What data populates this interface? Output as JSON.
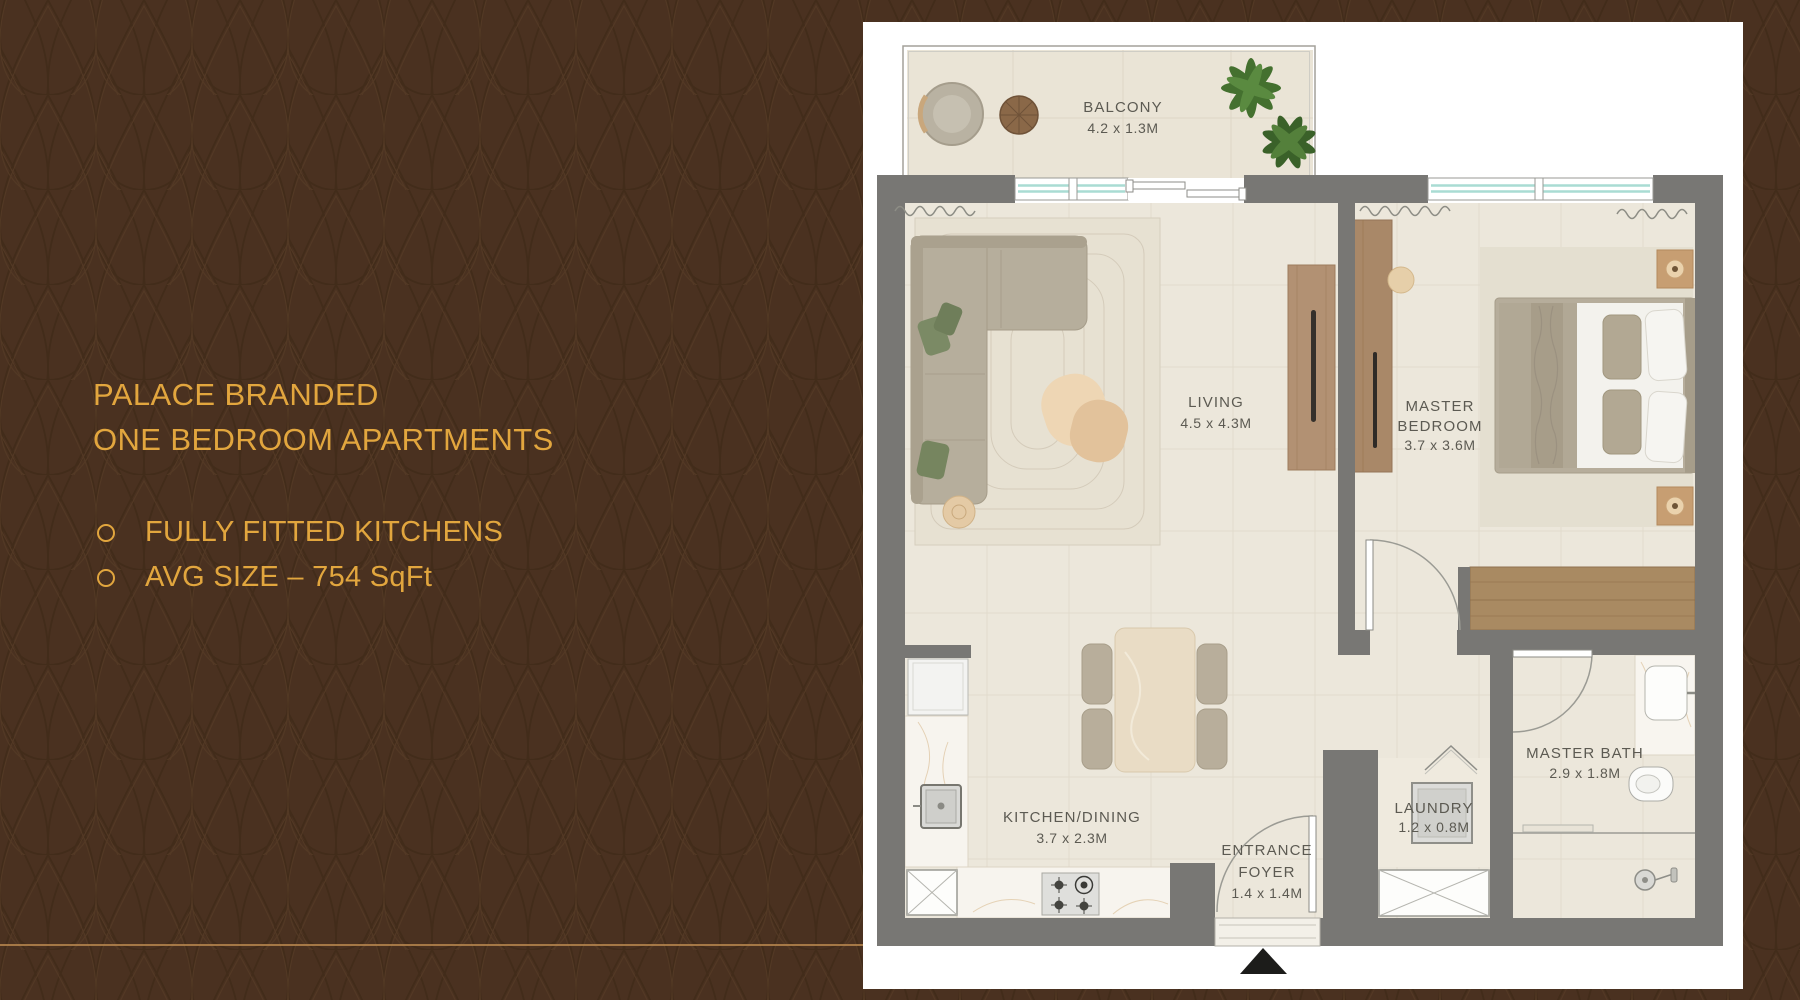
{
  "left_panel": {
    "title_line1": "PALACE BRANDED",
    "title_line2": "ONE BEDROOM APARTMENTS",
    "bullets": [
      "FULLY FITTED KITCHENS",
      "AVG SIZE – 754 SqFt"
    ]
  },
  "floor_plan": {
    "rooms": {
      "balcony": {
        "name": "BALCONY",
        "dims": "4.2 x 1.3M"
      },
      "living": {
        "name": "LIVING",
        "dims": "4.5 x 4.3M"
      },
      "master_bedroom": {
        "name_line1": "MASTER",
        "name_line2": "BEDROOM",
        "dims": "3.7 x 3.6M"
      },
      "kitchen_dining": {
        "name": "KITCHEN/DINING",
        "dims": "3.7 x 2.3M"
      },
      "entrance_foyer": {
        "name_line1": "ENTRANCE",
        "name_line2": "FOYER",
        "dims": "1.4 x 1.4M"
      },
      "laundry": {
        "name": "LAUNDRY",
        "dims": "1.2 x 0.8M"
      },
      "master_bath": {
        "name": "MASTER BATH",
        "dims": "2.9 x 1.8M"
      }
    }
  },
  "palette": {
    "background": "#4A3120",
    "pattern_line_dark": "#3C2715",
    "pattern_line_light": "#5A3F28",
    "accent_text": "#E2A63E",
    "rule_line": "#B5854E",
    "plan_sheet": "#FFFFFF",
    "wall": "#787774",
    "floor_tile": "#ECE7DB",
    "marble": "#F7F4EE",
    "window_glass": "#A9DCD3",
    "wood": "#A98868",
    "sofa": "#B6AE9C",
    "pillow_green": "#7B8A65",
    "plant_green": "#44702F",
    "label_text": "#5C5A52",
    "entrance_arrow": "#1C1C1A"
  }
}
